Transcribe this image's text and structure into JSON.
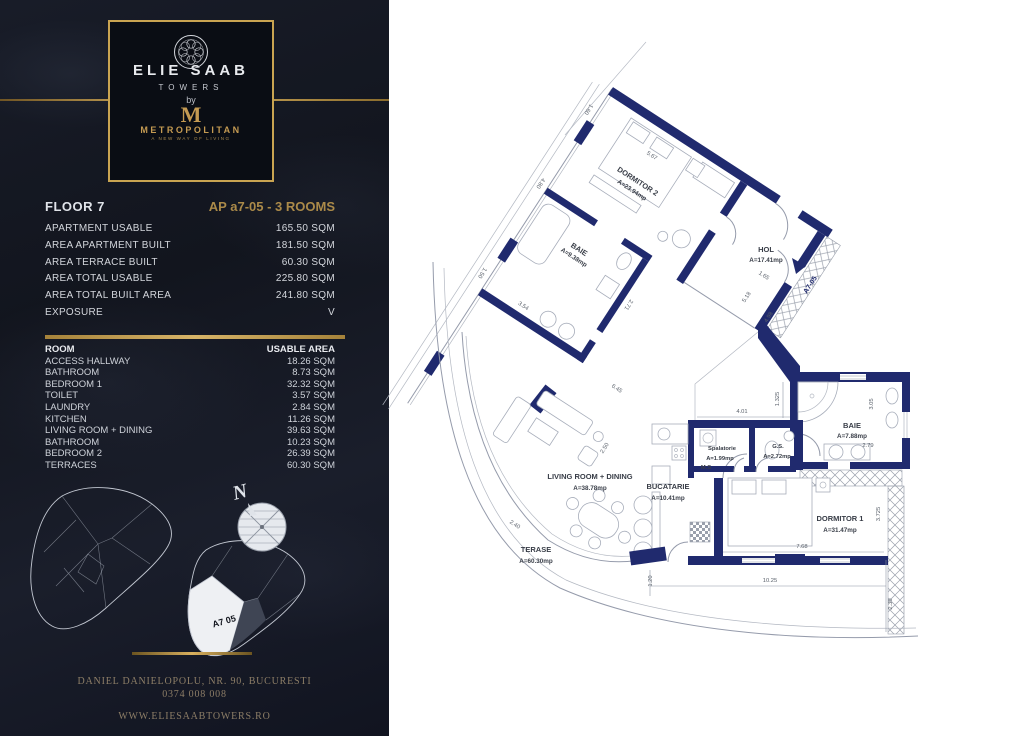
{
  "brand": {
    "name": "ELIE SAAB",
    "towers": "TOWERS",
    "by": "by",
    "partner": "METROPOLITAN",
    "tagline": "A NEW WAY OF LIVING"
  },
  "header": {
    "floor": "FLOOR 7",
    "unit": "AP a7-05 - 3 ROOMS"
  },
  "summary": {
    "rows": [
      {
        "label": "APARTMENT USABLE",
        "value": "165.50 SQM"
      },
      {
        "label": "AREA APARTMENT BUILT",
        "value": "181.50 SQM"
      },
      {
        "label": "AREA TERRACE BUILT",
        "value": "60.30 SQM"
      },
      {
        "label": "AREA TOTAL USABLE",
        "value": "225.80 SQM"
      },
      {
        "label": "AREA TOTAL BUILT AREA",
        "value": "241.80 SQM"
      },
      {
        "label": "EXPOSURE",
        "value": "V"
      }
    ]
  },
  "rooms_table": {
    "header": {
      "room": "ROOM",
      "area": "USABLE AREA"
    },
    "rows": [
      {
        "name": "ACCESS HALLWAY",
        "area": "18.26 SQM"
      },
      {
        "name": "BATHROOM",
        "area": "8.73 SQM"
      },
      {
        "name": "BEDROOM 1",
        "area": "32.32 SQM"
      },
      {
        "name": "TOILET",
        "area": "3.57 SQM"
      },
      {
        "name": "LAUNDRY",
        "area": "2.84 SQM"
      },
      {
        "name": "KITCHEN",
        "area": "11.26 SQM"
      },
      {
        "name": "LIVING ROOM + DINING",
        "area": "39.63 SQM"
      },
      {
        "name": "BATHROOM",
        "area": "10.23 SQM"
      },
      {
        "name": "BEDROOM 2",
        "area": "26.39 SQM"
      },
      {
        "name": "TERRACES",
        "area": "60.30 SQM"
      }
    ]
  },
  "site": {
    "north": "N",
    "unit_label": "A7 05"
  },
  "footer": {
    "address": "DANIEL DANIELOPOLU, NR. 90, BUCURESTI",
    "phone": "0374 008 008",
    "website": "WWW.ELIESAABTOWERS.RO"
  },
  "plan": {
    "unit_marker": "A7-05",
    "annotations": {
      "ms": "M.S"
    },
    "rooms": [
      {
        "name": "DORMITOR 2",
        "area": "A=23.94mp"
      },
      {
        "name": "BAIE",
        "area": "A=9.38mp"
      },
      {
        "name": "HOL",
        "area": "A=17.41mp"
      },
      {
        "name": "Spalatorie",
        "area": "A=1.99mp"
      },
      {
        "name": "G.S.",
        "area": "A=2.72mp"
      },
      {
        "name": "BAIE",
        "area": "A=7.88mp"
      },
      {
        "name": "DORMITOR 1",
        "area": "A=31.47mp"
      },
      {
        "name": "BUCATARIE",
        "area": "A=10.41mp"
      },
      {
        "name": "LIVING ROOM + DINING",
        "area": "A=38.78mp"
      },
      {
        "name": "TERASE",
        "area": "A=60.30mp"
      }
    ],
    "dims": [
      "5.67",
      "1.60",
      "4.80",
      "1.50",
      "3.54",
      "2.71",
      "1.65",
      "4.98",
      "5.18",
      "6.45",
      "2.50",
      "4.01",
      "1.325",
      "3.05",
      "2.79",
      "3.725",
      "7.68",
      "10.25",
      "2.30",
      "2.40",
      "1.20"
    ]
  }
}
